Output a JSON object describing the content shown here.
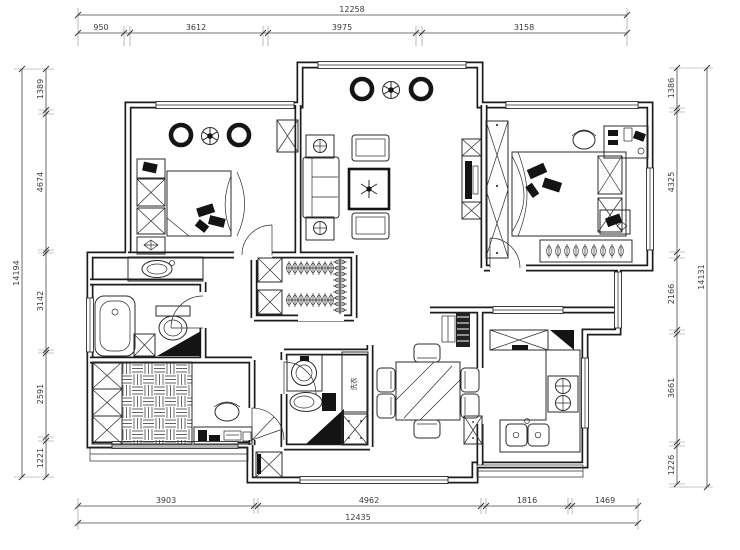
{
  "meta": {
    "type": "apartment-floor-plan"
  },
  "palette": {
    "line": "#1c1c1c",
    "background": "#ffffff",
    "dark_fill": "#141414"
  },
  "dimensions": {
    "top": {
      "overall": "12258",
      "segments": [
        "950",
        "3612",
        "3975",
        "3158"
      ]
    },
    "left": {
      "overall": "14194",
      "segments": [
        "1389",
        "4674",
        "3142",
        "2591",
        "1221"
      ]
    },
    "right": {
      "overall": "14131",
      "segments": [
        "1386",
        "4325",
        "2166",
        "3661",
        "1226"
      ]
    },
    "bottom": {
      "overall": "12435",
      "segments": [
        "3903",
        "4962",
        "1816",
        "1469"
      ]
    }
  },
  "labels": {
    "appliance": "洗衣"
  }
}
